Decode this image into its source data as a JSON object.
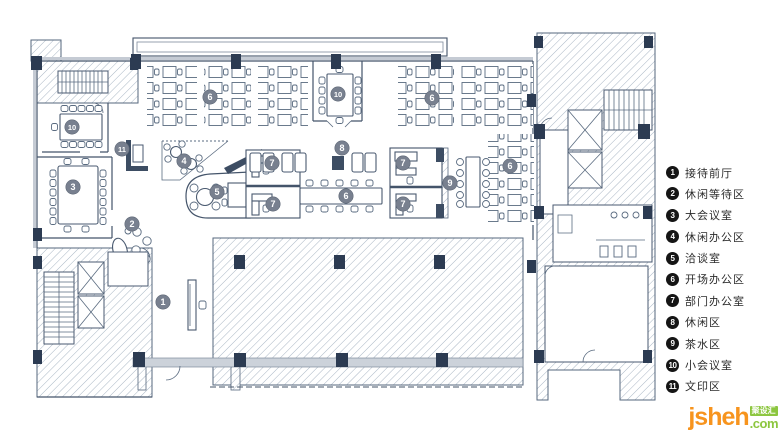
{
  "legend": {
    "items": [
      {
        "num": "1",
        "label": "接待前厅"
      },
      {
        "num": "2",
        "label": "休闲等待区"
      },
      {
        "num": "3",
        "label": "大会议室"
      },
      {
        "num": "4",
        "label": "休闲办公区"
      },
      {
        "num": "5",
        "label": "洽谈室"
      },
      {
        "num": "6",
        "label": "开场办公区"
      },
      {
        "num": "7",
        "label": "部门办公室"
      },
      {
        "num": "8",
        "label": "休闲区"
      },
      {
        "num": "9",
        "label": "茶水区"
      },
      {
        "num": "10",
        "label": "小会议室"
      },
      {
        "num": "11",
        "label": "文印区"
      }
    ]
  },
  "plan_markers": [
    "1",
    "2",
    "3",
    "4",
    "5",
    "6",
    "6",
    "6",
    "6",
    "7",
    "7",
    "7",
    "7",
    "8",
    "9",
    "10",
    "10",
    "11"
  ],
  "watermark": {
    "brand": "jsheh",
    "tld": ".com",
    "badge": "聚设汇"
  },
  "colors": {
    "plan_line": "#44546a",
    "hatch_line": "#a9b6c4",
    "column_fill": "#2c3b52",
    "plan_marker_fill": "#78808f",
    "legend_circle": "#151515",
    "brand_orange": "#f7941e",
    "brand_green": "#8cc63f"
  }
}
